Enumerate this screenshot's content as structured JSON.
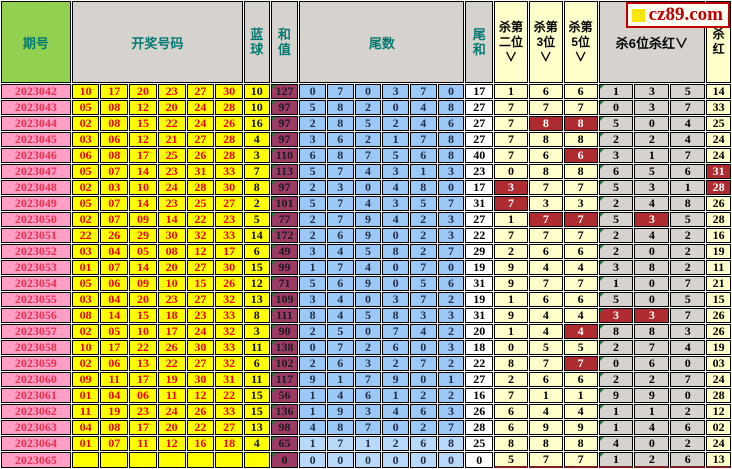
{
  "logo": {
    "text": "cz89.com",
    "square_color": "#ffe40a",
    "border_color": "#c00000"
  },
  "colors": {
    "header_green": "#92d050",
    "header_gray": "#d6d3ce",
    "header_teal_text": "#067a72",
    "period_pink": "#ff9fc5",
    "ball_yellow": "#ffff00",
    "ball_red_text": "#f00000",
    "sum_maroon": "#9c3a66",
    "tail_blue": "#9cc8f8",
    "kill_pale_yellow": "#ffffcc",
    "kill_gray": "#d6d3ce",
    "hit_red": "#ae2b30"
  },
  "header": {
    "period": "期号",
    "numbers": "开奖号码",
    "blue": "蓝球",
    "sum": "和值",
    "tails": "尾数",
    "tail_sum": "尾和",
    "kill2": "杀第二位∨",
    "kill3": "杀第3位∨",
    "kill5": "杀第5位∨",
    "kill6": "杀6位杀红∨",
    "kill_red": "杀红"
  },
  "rows": [
    {
      "period": "2023042",
      "reds": [
        "10",
        "17",
        "20",
        "23",
        "27",
        "30"
      ],
      "blue": "10",
      "sum": "127",
      "tails": [
        "0",
        "7",
        "0",
        "3",
        "7",
        "0"
      ],
      "tail_sum": "17",
      "kill2": {
        "v": "1"
      },
      "kill3": {
        "v": "6"
      },
      "kill5": {
        "v": "6"
      },
      "kill6": [
        {
          "v": "1"
        },
        {
          "v": "3"
        },
        {
          "v": "5"
        }
      ],
      "kill_red": {
        "v": "14"
      }
    },
    {
      "period": "2023043",
      "reds": [
        "05",
        "08",
        "12",
        "20",
        "24",
        "28"
      ],
      "blue": "10",
      "sum": "97",
      "tails": [
        "5",
        "8",
        "2",
        "0",
        "4",
        "8"
      ],
      "tail_sum": "27",
      "kill2": {
        "v": "7"
      },
      "kill3": {
        "v": "7"
      },
      "kill5": {
        "v": "7"
      },
      "kill6": [
        {
          "v": "0"
        },
        {
          "v": "3"
        },
        {
          "v": "7"
        }
      ],
      "kill_red": {
        "v": "33"
      }
    },
    {
      "period": "2023044",
      "reds": [
        "02",
        "08",
        "15",
        "22",
        "24",
        "26"
      ],
      "blue": "16",
      "sum": "97",
      "tails": [
        "2",
        "8",
        "5",
        "2",
        "4",
        "6"
      ],
      "tail_sum": "27",
      "kill2": {
        "v": "7"
      },
      "kill3": {
        "v": "8",
        "hit": true
      },
      "kill5": {
        "v": "8",
        "hit": true
      },
      "kill6": [
        {
          "v": "5"
        },
        {
          "v": "0"
        },
        {
          "v": "4"
        }
      ],
      "kill_red": {
        "v": "25"
      }
    },
    {
      "period": "2023045",
      "reds": [
        "03",
        "06",
        "12",
        "21",
        "27",
        "28"
      ],
      "blue": "4",
      "sum": "97",
      "tails": [
        "3",
        "6",
        "2",
        "1",
        "7",
        "8"
      ],
      "tail_sum": "27",
      "kill2": {
        "v": "7"
      },
      "kill3": {
        "v": "8"
      },
      "kill5": {
        "v": "8"
      },
      "kill6": [
        {
          "v": "2"
        },
        {
          "v": "2"
        },
        {
          "v": "4"
        }
      ],
      "kill_red": {
        "v": "24"
      }
    },
    {
      "period": "2023046",
      "reds": [
        "06",
        "08",
        "17",
        "25",
        "26",
        "28"
      ],
      "blue": "3",
      "sum": "110",
      "tails": [
        "6",
        "8",
        "7",
        "5",
        "6",
        "8"
      ],
      "tail_sum": "40",
      "kill2": {
        "v": "7"
      },
      "kill3": {
        "v": "6"
      },
      "kill5": {
        "v": "6",
        "hit": true
      },
      "kill6": [
        {
          "v": "3"
        },
        {
          "v": "1"
        },
        {
          "v": "7"
        }
      ],
      "kill_red": {
        "v": "24"
      }
    },
    {
      "period": "2023047",
      "reds": [
        "05",
        "07",
        "14",
        "23",
        "31",
        "33"
      ],
      "blue": "7",
      "sum": "113",
      "tails": [
        "5",
        "7",
        "4",
        "3",
        "1",
        "3"
      ],
      "tail_sum": "23",
      "kill2": {
        "v": "0"
      },
      "kill3": {
        "v": "8"
      },
      "kill5": {
        "v": "8"
      },
      "kill6": [
        {
          "v": "6"
        },
        {
          "v": "5"
        },
        {
          "v": "6"
        }
      ],
      "kill_red": {
        "v": "31",
        "hit": true
      }
    },
    {
      "period": "2023048",
      "reds": [
        "02",
        "03",
        "10",
        "24",
        "28",
        "30"
      ],
      "blue": "8",
      "sum": "97",
      "tails": [
        "2",
        "3",
        "0",
        "4",
        "8",
        "0"
      ],
      "tail_sum": "17",
      "kill2": {
        "v": "3",
        "hit": true
      },
      "kill3": {
        "v": "7"
      },
      "kill5": {
        "v": "7"
      },
      "kill6": [
        {
          "v": "5"
        },
        {
          "v": "3"
        },
        {
          "v": "1"
        }
      ],
      "kill_red": {
        "v": "28",
        "hit": true
      }
    },
    {
      "period": "2023049",
      "reds": [
        "05",
        "07",
        "14",
        "23",
        "25",
        "27"
      ],
      "blue": "2",
      "sum": "101",
      "tails": [
        "5",
        "7",
        "4",
        "3",
        "5",
        "7"
      ],
      "tail_sum": "31",
      "kill2": {
        "v": "7",
        "hit": true
      },
      "kill3": {
        "v": "3"
      },
      "kill5": {
        "v": "3"
      },
      "kill6": [
        {
          "v": "2"
        },
        {
          "v": "4"
        },
        {
          "v": "8"
        }
      ],
      "kill_red": {
        "v": "26"
      }
    },
    {
      "period": "2023050",
      "reds": [
        "02",
        "07",
        "09",
        "14",
        "22",
        "23"
      ],
      "blue": "5",
      "sum": "77",
      "tails": [
        "2",
        "7",
        "9",
        "4",
        "2",
        "3"
      ],
      "tail_sum": "27",
      "kill2": {
        "v": "1"
      },
      "kill3": {
        "v": "7",
        "hit": true
      },
      "kill5": {
        "v": "7",
        "hit": true
      },
      "kill6": [
        {
          "v": "5"
        },
        {
          "v": "3",
          "hit": true
        },
        {
          "v": "5"
        }
      ],
      "kill_red": {
        "v": "28"
      }
    },
    {
      "period": "2023051",
      "reds": [
        "22",
        "26",
        "29",
        "30",
        "32",
        "33"
      ],
      "blue": "14",
      "sum": "172",
      "tails": [
        "2",
        "6",
        "9",
        "0",
        "2",
        "3"
      ],
      "tail_sum": "22",
      "kill2": {
        "v": "7"
      },
      "kill3": {
        "v": "7"
      },
      "kill5": {
        "v": "7"
      },
      "kill6": [
        {
          "v": "2"
        },
        {
          "v": "4"
        },
        {
          "v": "2"
        }
      ],
      "kill_red": {
        "v": "16"
      }
    },
    {
      "period": "2023052",
      "reds": [
        "03",
        "04",
        "05",
        "08",
        "12",
        "17"
      ],
      "blue": "6",
      "sum": "49",
      "tails": [
        "3",
        "4",
        "5",
        "8",
        "2",
        "7"
      ],
      "tail_sum": "29",
      "kill2": {
        "v": "2"
      },
      "kill3": {
        "v": "6"
      },
      "kill5": {
        "v": "6"
      },
      "kill6": [
        {
          "v": "2"
        },
        {
          "v": "0"
        },
        {
          "v": "2"
        }
      ],
      "kill_red": {
        "v": "19"
      }
    },
    {
      "period": "2023053",
      "reds": [
        "01",
        "07",
        "14",
        "20",
        "27",
        "30"
      ],
      "blue": "15",
      "sum": "99",
      "tails": [
        "1",
        "7",
        "4",
        "0",
        "7",
        "0"
      ],
      "tail_sum": "19",
      "kill2": {
        "v": "9"
      },
      "kill3": {
        "v": "4"
      },
      "kill5": {
        "v": "4"
      },
      "kill6": [
        {
          "v": "3"
        },
        {
          "v": "8"
        },
        {
          "v": "2"
        }
      ],
      "kill_red": {
        "v": "11"
      }
    },
    {
      "period": "2023054",
      "reds": [
        "05",
        "06",
        "09",
        "10",
        "15",
        "26"
      ],
      "blue": "12",
      "sum": "71",
      "tails": [
        "5",
        "6",
        "9",
        "0",
        "5",
        "6"
      ],
      "tail_sum": "31",
      "kill2": {
        "v": "9"
      },
      "kill3": {
        "v": "7"
      },
      "kill5": {
        "v": "7"
      },
      "kill6": [
        {
          "v": "1"
        },
        {
          "v": "0"
        },
        {
          "v": "7"
        }
      ],
      "kill_red": {
        "v": "21"
      }
    },
    {
      "period": "2023055",
      "reds": [
        "03",
        "04",
        "20",
        "23",
        "27",
        "32"
      ],
      "blue": "13",
      "sum": "109",
      "tails": [
        "3",
        "4",
        "0",
        "3",
        "7",
        "2"
      ],
      "tail_sum": "19",
      "kill2": {
        "v": "1"
      },
      "kill3": {
        "v": "6"
      },
      "kill5": {
        "v": "6"
      },
      "kill6": [
        {
          "v": "5"
        },
        {
          "v": "0"
        },
        {
          "v": "5"
        }
      ],
      "kill_red": {
        "v": "15"
      }
    },
    {
      "period": "2023056",
      "reds": [
        "08",
        "14",
        "15",
        "18",
        "23",
        "33"
      ],
      "blue": "8",
      "sum": "111",
      "tails": [
        "8",
        "4",
        "5",
        "8",
        "3",
        "3"
      ],
      "tail_sum": "31",
      "kill2": {
        "v": "9"
      },
      "kill3": {
        "v": "4"
      },
      "kill5": {
        "v": "4"
      },
      "kill6": [
        {
          "v": "3",
          "hit": true
        },
        {
          "v": "3",
          "hit": true
        },
        {
          "v": "7"
        }
      ],
      "kill_red": {
        "v": "26"
      }
    },
    {
      "period": "2023057",
      "reds": [
        "02",
        "05",
        "10",
        "17",
        "24",
        "32"
      ],
      "blue": "3",
      "sum": "90",
      "tails": [
        "2",
        "5",
        "0",
        "7",
        "4",
        "2"
      ],
      "tail_sum": "20",
      "kill2": {
        "v": "1"
      },
      "kill3": {
        "v": "4"
      },
      "kill5": {
        "v": "4",
        "hit": true
      },
      "kill6": [
        {
          "v": "8"
        },
        {
          "v": "8"
        },
        {
          "v": "3"
        }
      ],
      "kill_red": {
        "v": "26"
      }
    },
    {
      "period": "2023058",
      "reds": [
        "10",
        "17",
        "22",
        "26",
        "30",
        "33"
      ],
      "blue": "11",
      "sum": "138",
      "tails": [
        "0",
        "7",
        "2",
        "6",
        "0",
        "3"
      ],
      "tail_sum": "18",
      "kill2": {
        "v": "0"
      },
      "kill3": {
        "v": "5"
      },
      "kill5": {
        "v": "5"
      },
      "kill6": [
        {
          "v": "2"
        },
        {
          "v": "7"
        },
        {
          "v": "4"
        }
      ],
      "kill_red": {
        "v": "19"
      }
    },
    {
      "period": "2023059",
      "reds": [
        "02",
        "06",
        "13",
        "22",
        "27",
        "32"
      ],
      "blue": "6",
      "sum": "102",
      "tails": [
        "2",
        "6",
        "3",
        "2",
        "7",
        "2"
      ],
      "tail_sum": "22",
      "kill2": {
        "v": "8"
      },
      "kill3": {
        "v": "7"
      },
      "kill5": {
        "v": "7",
        "hit": true
      },
      "kill6": [
        {
          "v": "0"
        },
        {
          "v": "6"
        },
        {
          "v": "0"
        }
      ],
      "kill_red": {
        "v": "03"
      }
    },
    {
      "period": "2023060",
      "reds": [
        "09",
        "11",
        "17",
        "19",
        "30",
        "31"
      ],
      "blue": "11",
      "sum": "117",
      "tails": [
        "9",
        "1",
        "7",
        "9",
        "0",
        "1"
      ],
      "tail_sum": "27",
      "kill2": {
        "v": "2"
      },
      "kill3": {
        "v": "6"
      },
      "kill5": {
        "v": "6"
      },
      "kill6": [
        {
          "v": "2"
        },
        {
          "v": "2"
        },
        {
          "v": "7"
        }
      ],
      "kill_red": {
        "v": "24"
      }
    },
    {
      "period": "2023061",
      "reds": [
        "01",
        "04",
        "06",
        "11",
        "12",
        "22"
      ],
      "blue": "15",
      "sum": "56",
      "tails": [
        "1",
        "4",
        "6",
        "1",
        "2",
        "2"
      ],
      "tail_sum": "16",
      "kill2": {
        "v": "7"
      },
      "kill3": {
        "v": "1"
      },
      "kill5": {
        "v": "1"
      },
      "kill6": [
        {
          "v": "9"
        },
        {
          "v": "9"
        },
        {
          "v": "0"
        }
      ],
      "kill_red": {
        "v": "28"
      }
    },
    {
      "period": "2023062",
      "reds": [
        "11",
        "19",
        "23",
        "24",
        "26",
        "33"
      ],
      "blue": "15",
      "sum": "136",
      "tails": [
        "1",
        "9",
        "3",
        "4",
        "6",
        "3"
      ],
      "tail_sum": "26",
      "kill2": {
        "v": "6"
      },
      "kill3": {
        "v": "4"
      },
      "kill5": {
        "v": "4"
      },
      "kill6": [
        {
          "v": "1"
        },
        {
          "v": "1"
        },
        {
          "v": "2"
        }
      ],
      "kill_red": {
        "v": "12"
      }
    },
    {
      "period": "2023063",
      "reds": [
        "04",
        "08",
        "17",
        "20",
        "22",
        "27"
      ],
      "blue": "13",
      "sum": "98",
      "tails": [
        "4",
        "8",
        "7",
        "0",
        "2",
        "7"
      ],
      "tail_sum": "28",
      "kill2": {
        "v": "6"
      },
      "kill3": {
        "v": "9"
      },
      "kill5": {
        "v": "9"
      },
      "kill6": [
        {
          "v": "1"
        },
        {
          "v": "4"
        },
        {
          "v": "6"
        }
      ],
      "kill_red": {
        "v": "02"
      }
    },
    {
      "period": "2023064",
      "reds": [
        "01",
        "07",
        "11",
        "12",
        "16",
        "18"
      ],
      "blue": "4",
      "sum": "65",
      "tails": [
        "1",
        "7",
        "1",
        "2",
        "6",
        "8"
      ],
      "tail_sum": "25",
      "light": true,
      "kill2": {
        "v": "8"
      },
      "kill3": {
        "v": "8"
      },
      "kill5": {
        "v": "8"
      },
      "kill6": [
        {
          "v": "4"
        },
        {
          "v": "0"
        },
        {
          "v": "2"
        }
      ],
      "kill_red": {
        "v": "24"
      }
    },
    {
      "period": "2023065",
      "reds": [
        "",
        "",
        "",
        "",
        "",
        ""
      ],
      "blue": "",
      "sum": "0",
      "tails": [
        "0",
        "0",
        "0",
        "0",
        "0",
        "0"
      ],
      "tail_sum": "0",
      "light": true,
      "kill2": {
        "v": "5"
      },
      "kill3": {
        "v": "7"
      },
      "kill5": {
        "v": "7"
      },
      "kill6": [
        {
          "v": "1"
        },
        {
          "v": "2"
        },
        {
          "v": "6"
        }
      ],
      "kill_red": {
        "v": "13"
      }
    }
  ]
}
